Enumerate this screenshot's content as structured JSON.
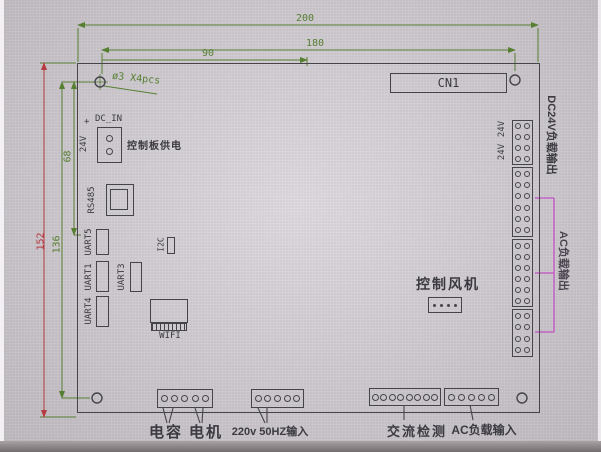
{
  "colors": {
    "dimension_green": "#567f32",
    "dimension_red": "#b5393f",
    "bracket_magenta": "#c44fc4",
    "line_dark": "#45444b"
  },
  "dimensions": {
    "width_total": "200",
    "width_180": "180",
    "width_90": "90",
    "height_total": "152",
    "height_136": "136",
    "height_68": "68",
    "hole_note": "ø3 X4pcs"
  },
  "board": {
    "cn1": "CN1",
    "dc_in": {
      "label": "DC_IN",
      "plus": "+",
      "voltage": "24V",
      "desc": "控制板供电",
      "pins": 2
    },
    "rs485": "RS485",
    "uart5": "UART5",
    "uart1": "UART1",
    "uart4": "UART4",
    "uart3": "UART3",
    "i2c": "I2C",
    "wifi": "WIFI",
    "fan": {
      "label": "控制风机",
      "pins": 4
    }
  },
  "right_side": {
    "v24_a": "24V",
    "v24_b": "24V",
    "dc24_out_label": "DC24V负载输出",
    "ac_out_label": "AC负载输出",
    "connectors": [
      {
        "rows": 4
      },
      {
        "rows": 6
      },
      {
        "rows": 6
      },
      {
        "rows": 4
      }
    ]
  },
  "bottom": {
    "cap_motor": {
      "pins": 5,
      "label_cap": "电容",
      "label_motor": "电机"
    },
    "mains": {
      "pins": 5,
      "label": "220v 50HZ输入"
    },
    "ac_detect": {
      "pins": 8,
      "label": "交流检测"
    },
    "ac_load_in": {
      "pins": 5,
      "label": "AC负载输入"
    }
  }
}
